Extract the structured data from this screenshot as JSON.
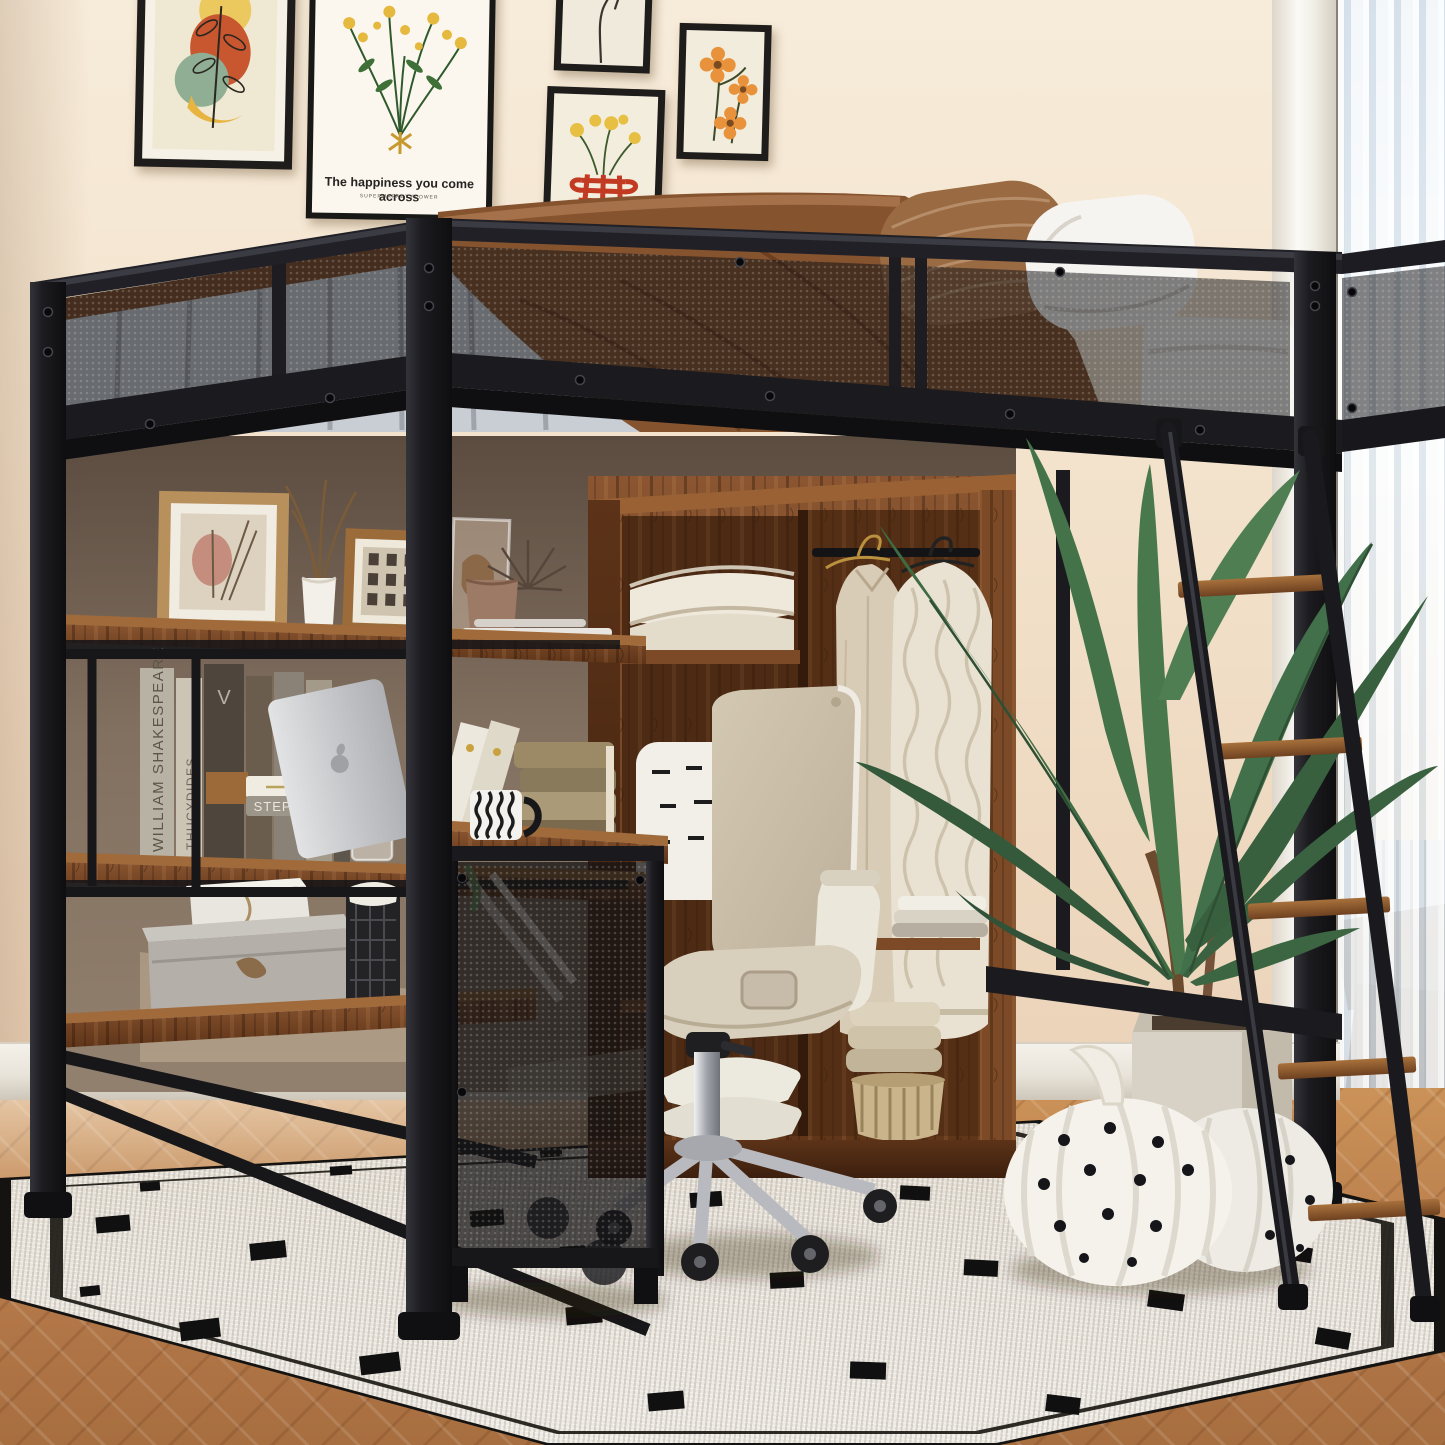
{
  "scene": {
    "description": "Black metal loft bed with mesh guardrail over a desk, bookshelves and open wardrobe in a beige bedroom",
    "room": {
      "wall_color": "#f2e2cd",
      "metal_color": "#1b1b1f",
      "wood_color": "#7a4a26",
      "floor": "herringbone wood floor",
      "rug": "ivory woven rug with black dash pattern",
      "window": "white molding with sheer curtain"
    },
    "wall_art": {
      "frame_abstract": "abstract botanical shapes print",
      "frame_bouquet": {
        "caption": "The happiness you come across",
        "subcaption": "SUPERMARKET FLOWER"
      },
      "frame_hand": "hand line-art print",
      "frame_vase": "red vase with yellow flowers print",
      "frame_orange": "orange wildflowers print"
    },
    "books": {
      "spine_shakespeare": "WILLIAM SHAKESPEARE",
      "spine_thucydides": "THUCYDIDES",
      "spine_monogram": "V",
      "spine_stephen_king": "STEPHEN KING"
    },
    "furniture": {
      "bed": "loft bed with mesh guardrail",
      "bedding": [
        "grey sheet",
        "brown blanket",
        "brown striped pillow",
        "white pillow",
        "white mattress"
      ],
      "ladder": "angled ladder with wooden rungs",
      "wardrobe": "open wardrobe with hanging clothes",
      "desk_cabinet": "desk with mesh side cabinet",
      "chair": "beige swivel office chair",
      "shelf_items": [
        "picture frames",
        "vase with dried stems",
        "laptop",
        "striped mug",
        "storage boxes",
        "wire basket"
      ],
      "decor": [
        "potted leafy plant",
        "polka-dot plush pumpkins"
      ]
    }
  }
}
